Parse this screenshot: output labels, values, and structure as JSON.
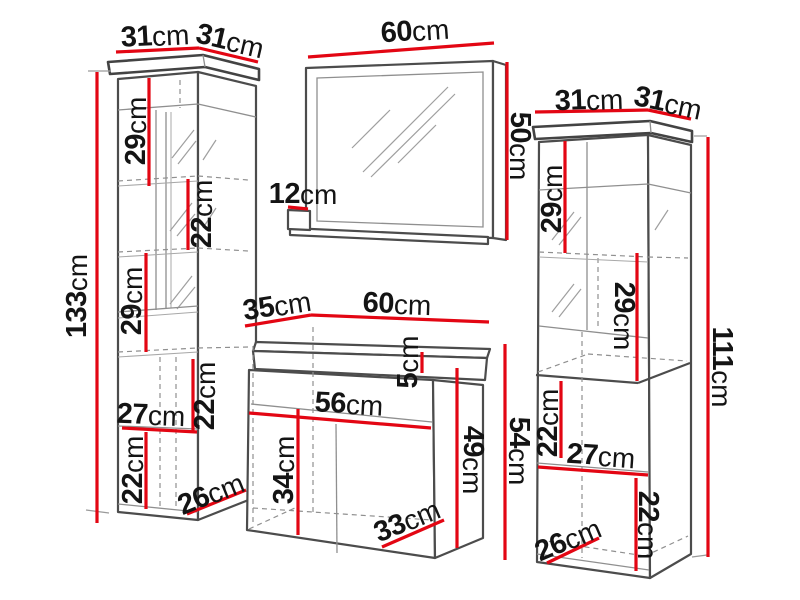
{
  "colors": {
    "dimension_line": "#e30613",
    "outline_dark": "#4c4c4c",
    "outline_light": "#8f8f8f",
    "label_text": "#141414",
    "background": "#ffffff"
  },
  "left_cabinet": {
    "dims": {
      "width": {
        "v": "31",
        "u": "cm"
      },
      "depth": {
        "v": "31",
        "u": "cm"
      },
      "height": {
        "v": "133",
        "u": "cm"
      },
      "section_top": {
        "v": "29",
        "u": "cm"
      },
      "section_upper": {
        "v": "22",
        "u": "cm"
      },
      "section_middle": {
        "v": "29",
        "u": "cm"
      },
      "section_lower": {
        "v": "22",
        "u": "cm"
      },
      "inner_width": {
        "v": "27",
        "u": "cm"
      },
      "section_bottom": {
        "v": "22",
        "u": "cm"
      },
      "base_depth": {
        "v": "26",
        "u": "cm"
      }
    }
  },
  "mirror": {
    "dims": {
      "width": {
        "v": "60",
        "u": "cm"
      },
      "height": {
        "v": "50",
        "u": "cm"
      },
      "shelf_depth": {
        "v": "12",
        "u": "cm"
      }
    }
  },
  "vanity": {
    "dims": {
      "depth": {
        "v": "35",
        "u": "cm"
      },
      "width": {
        "v": "60",
        "u": "cm"
      },
      "top_height": {
        "v": "5",
        "u": "cm"
      },
      "inner_width": {
        "v": "56",
        "u": "cm"
      },
      "door_height": {
        "v": "34",
        "u": "cm"
      },
      "inner_height": {
        "v": "49",
        "u": "cm"
      },
      "height": {
        "v": "54",
        "u": "cm"
      },
      "base_depth": {
        "v": "33",
        "u": "cm"
      }
    }
  },
  "right_cabinet": {
    "dims": {
      "width": {
        "v": "31",
        "u": "cm"
      },
      "depth": {
        "v": "31",
        "u": "cm"
      },
      "height": {
        "v": "111",
        "u": "cm"
      },
      "section_top": {
        "v": "29",
        "u": "cm"
      },
      "section_upper": {
        "v": "29",
        "u": "cm"
      },
      "section_lower": {
        "v": "22",
        "u": "cm"
      },
      "inner_width": {
        "v": "27",
        "u": "cm"
      },
      "section_bottom": {
        "v": "22",
        "u": "cm"
      },
      "base_depth": {
        "v": "26",
        "u": "cm"
      }
    }
  }
}
